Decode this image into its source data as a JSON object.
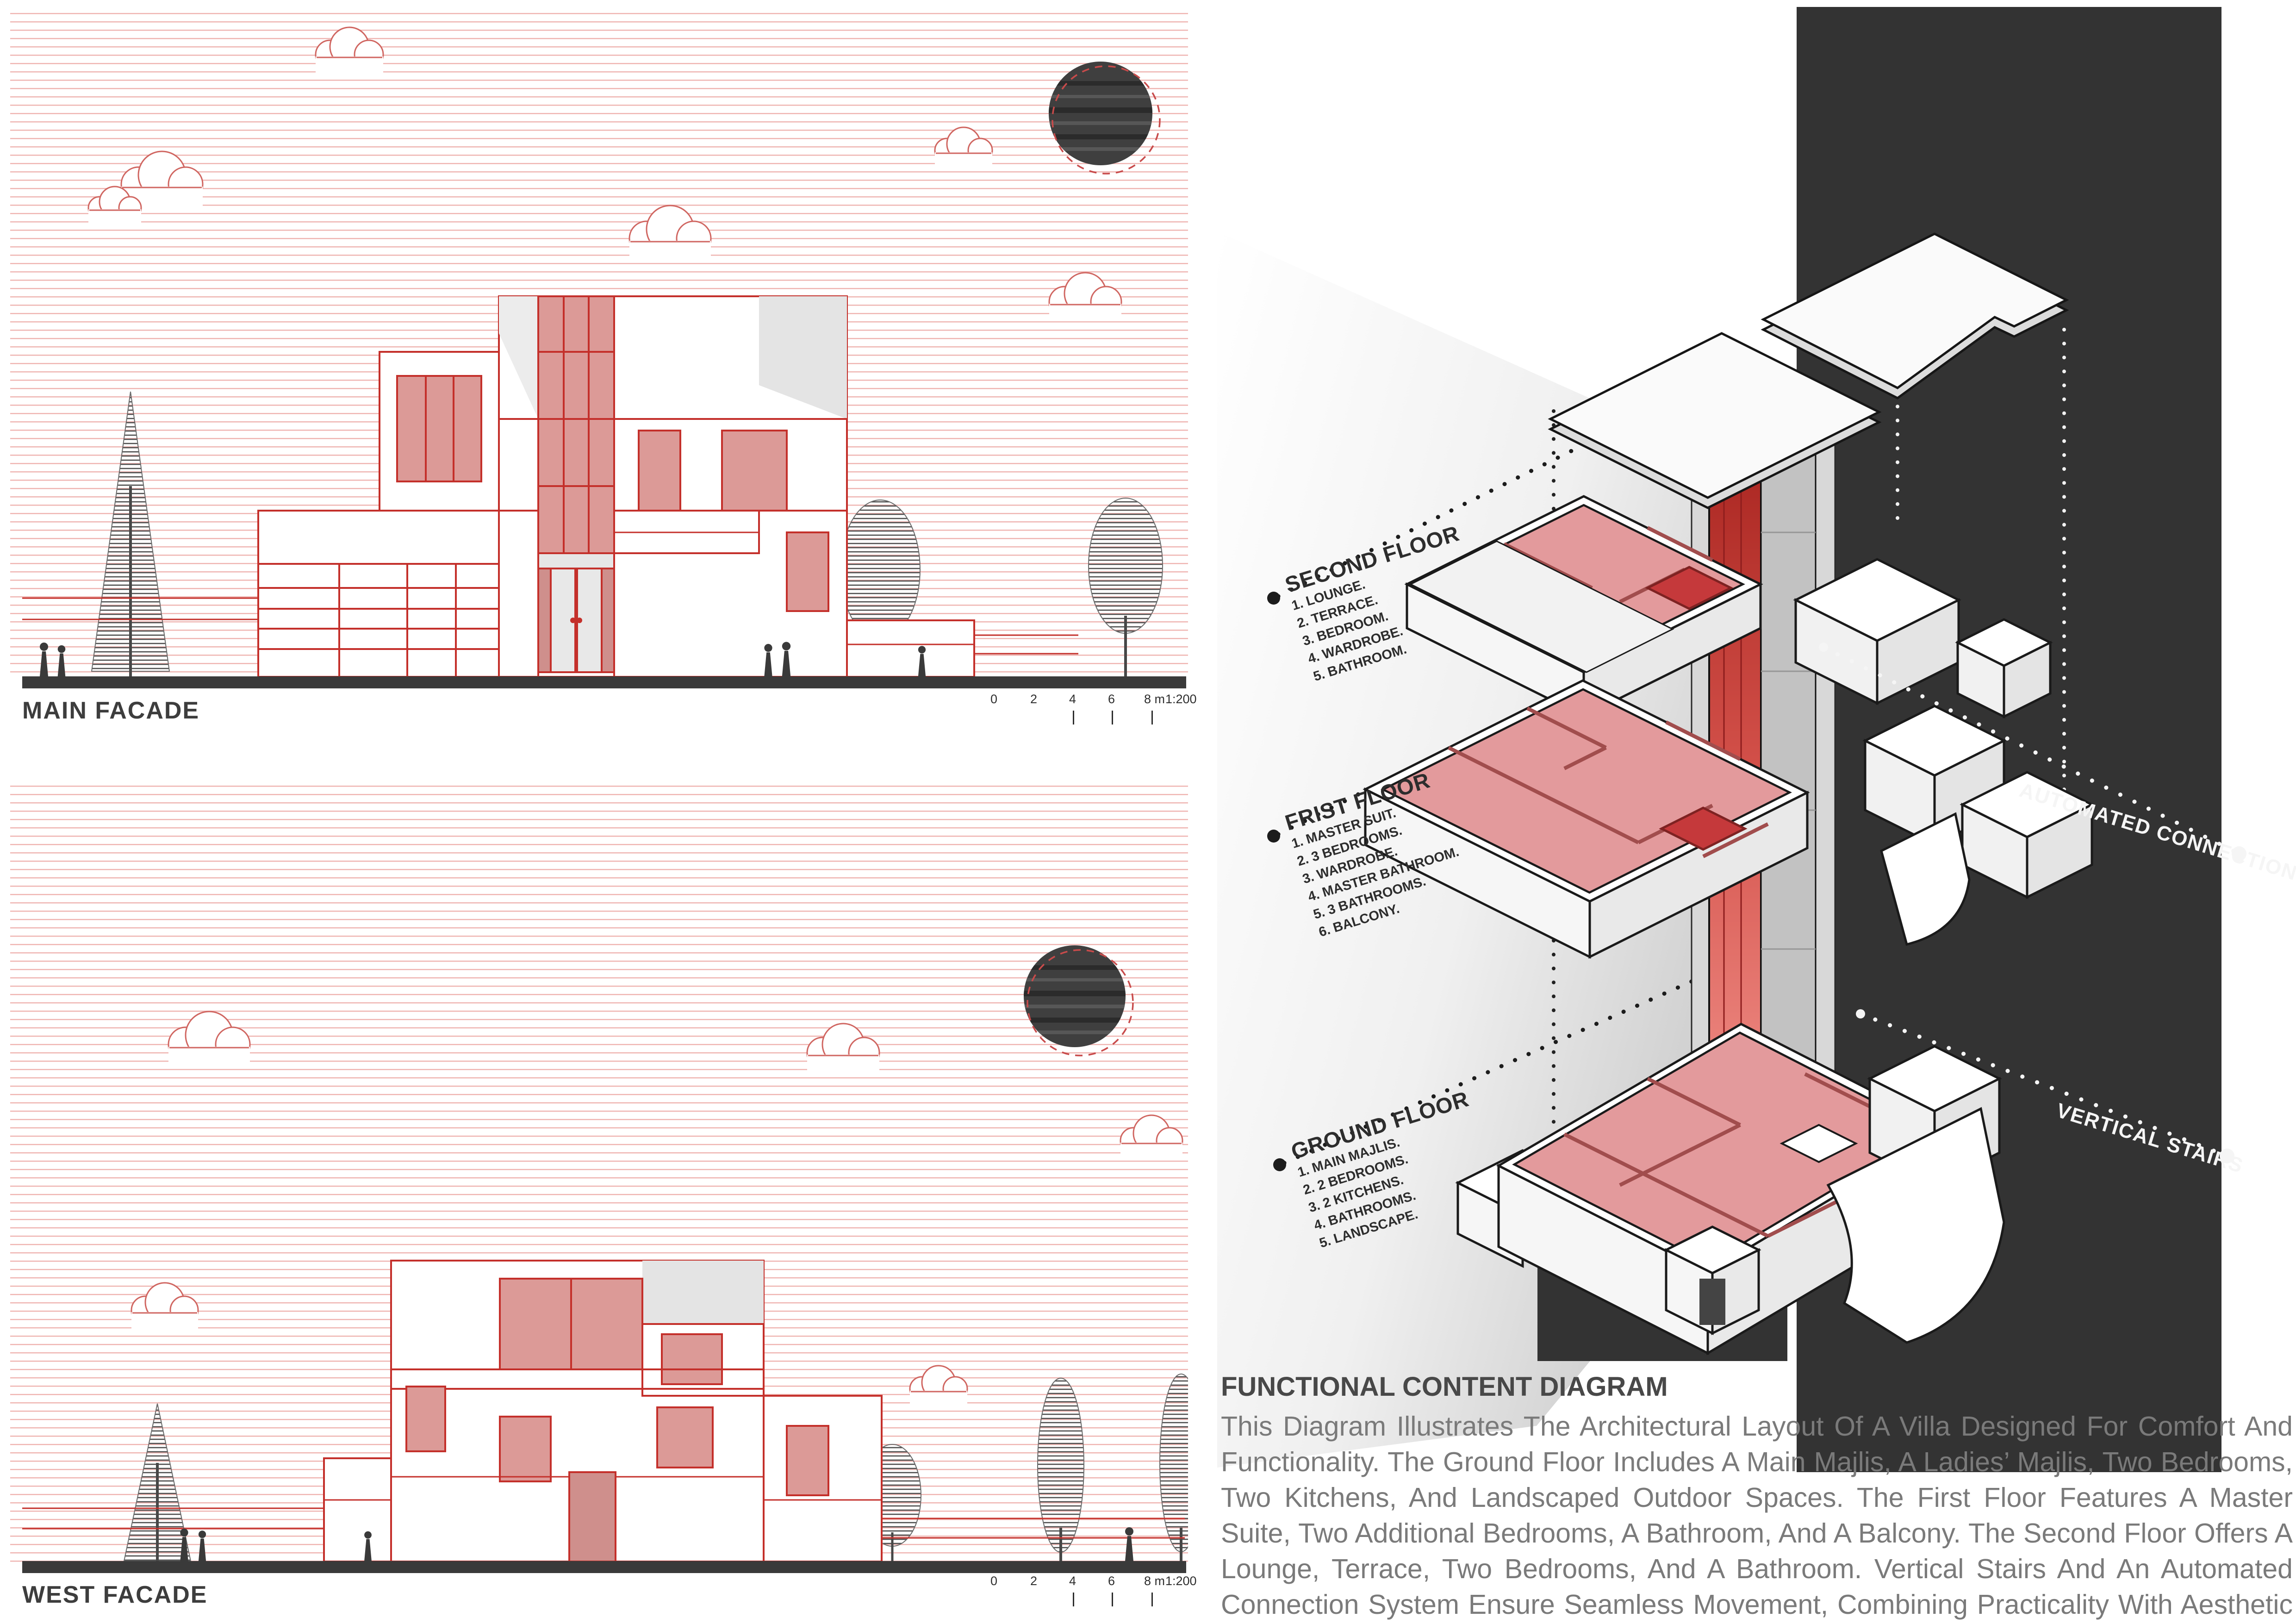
{
  "left": {
    "main_facade_label": "MAIN FACADE",
    "west_facade_label": "WEST FACADE",
    "scale": {
      "t0": "0",
      "t1": "2",
      "t2": "4",
      "t3": "6",
      "t4": "8 m",
      "ratio": "1:200"
    }
  },
  "right": {
    "floors": [
      {
        "title": "SECOND FLOOR",
        "items": [
          "1. LOUNGE.",
          "2. TERRACE.",
          "3. BEDROOM.",
          "4. WARDROBE.",
          "5. BATHROOM."
        ]
      },
      {
        "title": "FRIST FLOOR",
        "items": [
          "1. MASTER SUIT.",
          "2. 3 BEDROOMS.",
          "3. WARDROBE.",
          "4. MASTER BATHROOM.",
          "5. 3 BATHROOMS.",
          "6. BALCONY."
        ]
      },
      {
        "title": "GROUND FLOOR",
        "items": [
          "1. MAIN MAJLIS.",
          "2. 2 BEDROOMS.",
          "3. 2 KITCHENS.",
          "4. BATHROOMS.",
          "5. LANDSCAPE."
        ]
      }
    ],
    "annotations": {
      "automated": "AUTOMATED CONNECTION",
      "stairs": "VERTICAL STAIRS"
    },
    "summary": {
      "title": "FUNCTIONAL CONTENT DIAGRAM",
      "body": "This Diagram Illustrates The Architectural Layout Of A Villa Designed For Comfort And Functionality. The Ground Floor Includes A Main Majlis, A Ladies’ Majlis, Two Bedrooms, Two Kitchens, And Landscaped Outdoor Spaces. The First Floor Features A Master Suite, Two Additional Bedrooms, A Bathroom, And A Balcony. The Second Floor Offers A Lounge, Terrace, Two Bedrooms, And A Bathroom. Vertical Stairs And An Automated Connection System Ensure Seamless Movement, Combining Practicality With Aesthetic Appeal For A Unique Living Experience."
    }
  },
  "colors": {
    "line_red": "#c4302b",
    "fill_pink": "#dc9a97",
    "room_pink": "#e39a9c",
    "dark_panel": "#333333",
    "ground_bar": "#3a3a3a",
    "body_text": "#7a7a7a"
  }
}
